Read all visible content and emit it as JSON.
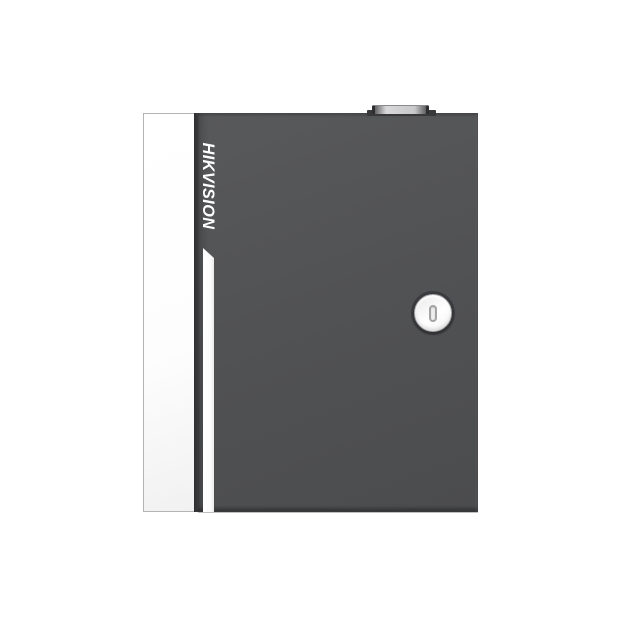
{
  "page": {
    "background": "#ffffff"
  },
  "product": {
    "brand": "HIKVISION",
    "description": "Dark gray metal enclosure with white door-edge panel, vertical brand logo, white accent stripe, top latch knob and circular cam lock with vertical keyhole",
    "colors": {
      "pageBg": "#ffffff",
      "body": "#505153",
      "edgeDark": "#3a3a3c",
      "panelBorder": "#b4b4b6",
      "stripeWhite": "#fbfbfc",
      "logoText": "#ffffff",
      "lockFace": "#ffffff",
      "lockRim": "#a6a6a8",
      "slotGray": "#a3a3a5",
      "knobBase": "#39393b",
      "knobCapLight": "#d8d8da"
    }
  }
}
